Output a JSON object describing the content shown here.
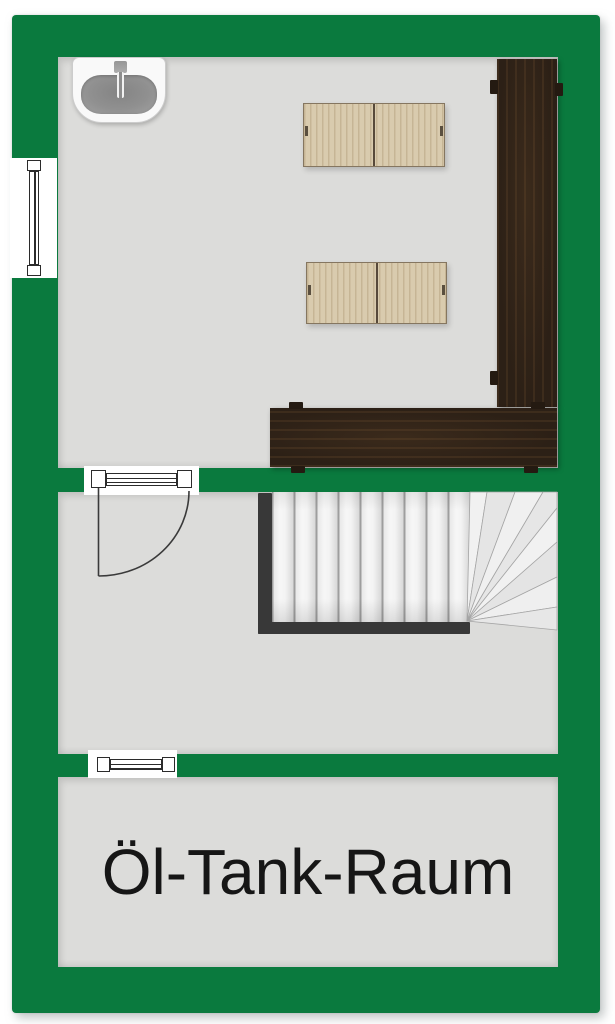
{
  "plan": {
    "label_oil_tank_room": "Öl-Tank-Raum",
    "rooms": [
      {
        "name": "utility-room-top",
        "fixtures": [
          "sink",
          "cabinet",
          "cabinet",
          "bench-right",
          "bench-bottom"
        ]
      },
      {
        "name": "stair-hall",
        "fixtures": [
          "door",
          "winder-staircase"
        ]
      },
      {
        "name": "oil-tank-room",
        "label": "Öl-Tank-Raum"
      }
    ],
    "fixtures": {
      "sink": "washbasin-icon",
      "cabinet_count": 2,
      "stairs": {
        "type": "winder-staircase",
        "straight_treads": 9,
        "winder_treads": 8
      },
      "door": "swing-door-icon",
      "windows": [
        "window-left-wall",
        "window-between-hall-and-oil-room"
      ]
    },
    "colors": {
      "wall": "#0a7a3e",
      "floor": "#dcdcda",
      "bench_wood": "#2c2016",
      "cabinet_wood": "#d9cbae",
      "stair_frame": "#383838",
      "label_text": "#161616",
      "background": "#ffffff"
    }
  }
}
